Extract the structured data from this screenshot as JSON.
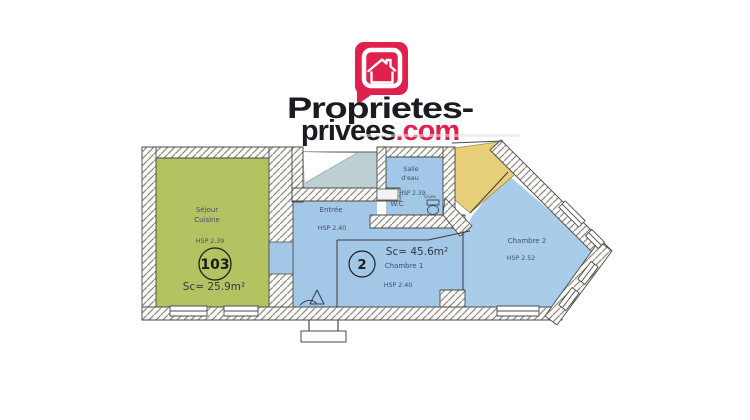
{
  "brand": {
    "line1": "Proprietes-",
    "line2_dark": "privees",
    "line2_accent": ".com",
    "accent_color": "#e2204e",
    "text_color": "#1b1c22",
    "icon": "house-speech-bubble-icon"
  },
  "floorplan": {
    "sejour": {
      "name": "Séjour",
      "name2": "Cuisine",
      "hsp": "HSP 2.39",
      "lot": "103",
      "area": "Sc= 25.9m²"
    },
    "entree": {
      "name": "Entrée",
      "hsp": "HSP 2.40"
    },
    "salle_eau": {
      "name": "Salle",
      "name2": "d'eau",
      "hsp": "HSP 2.39"
    },
    "wc": {
      "name": "W.C"
    },
    "gaine": {
      "name": "Gaine"
    },
    "chambre1": {
      "name": "Chambre 1",
      "hsp": "HSP 2.40",
      "lot": "2",
      "area": "Sc= 45.6m²"
    },
    "chambre2": {
      "name": "Chambre 2",
      "hsp": "HSP 2.52"
    },
    "colors": {
      "sejour": "#b5c261",
      "rooms_blue": "#a3c7e6",
      "chambre2_blue": "#a8cce9",
      "stairwell_gray": "#bccfd3",
      "adjacent_yellow": "#e6cf78",
      "wall_line": "#4a4a4a"
    }
  }
}
